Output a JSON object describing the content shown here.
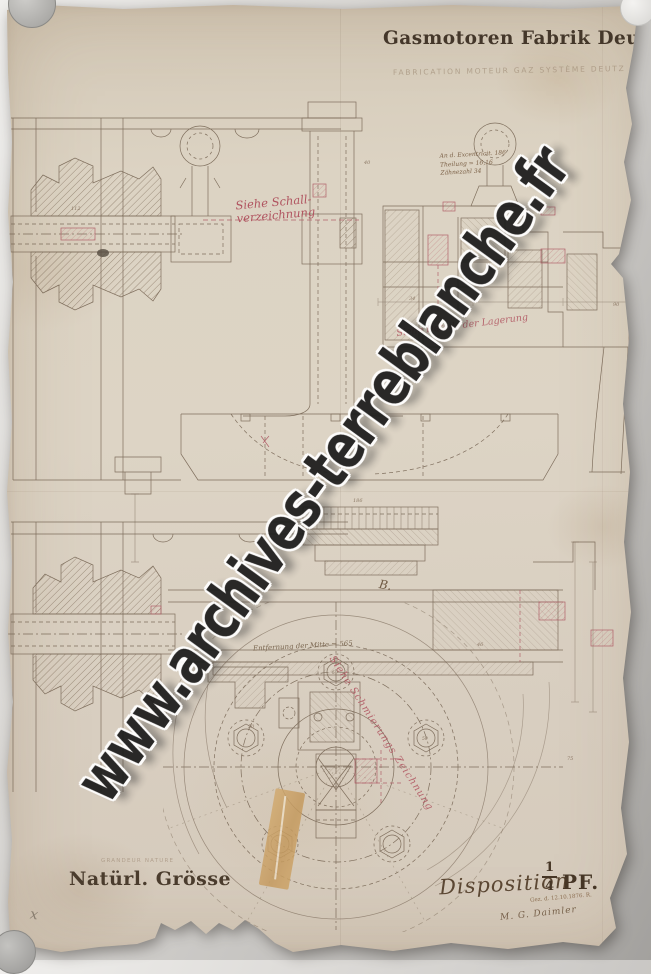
{
  "colors": {
    "paper": "#d8cec0",
    "ink": "#6b5947",
    "title_ink": "#44372a",
    "red_ink": "#a84a58",
    "watermark": "#1b1b1b"
  },
  "watermark": {
    "text": "www.archives-terreblanche.fr"
  },
  "header": {
    "title": "Gasmotoren Fabrik Deutz",
    "pencil_subtitle": "FABRICATION MOTEUR GAZ SYSTÈME DEUTZ"
  },
  "annotations": {
    "red_note_top": [
      "Siehe Schall-",
      "verzeichnung"
    ],
    "ink_note": [
      "An d. Excentricit. 186",
      "Theilung = 16,16",
      "Zähnezahl 34"
    ],
    "red_note_mid": "Siehe Details der Lagerung",
    "red_note_diag": "Siehe Schmierungs Zeichnung",
    "measure_note": "Entfernung der Mitte = 565",
    "mark_b": "B.",
    "pencil_x": "x"
  },
  "drawing": {
    "dims": [
      "40",
      "112",
      "34",
      "90",
      "46",
      "186",
      "75",
      "50"
    ],
    "bolt_label": "50"
  },
  "footer": {
    "pencil_left": "GRANDEUR NATURE",
    "scale_label": "Natürl. Grösse",
    "disposition_label": "Disposition",
    "fraction": {
      "numerator": "1",
      "denominator": "4"
    },
    "unit": "PF.",
    "date_note": "Gez. d. 12.10.1876. R.",
    "signature": "M. G. Daimler"
  }
}
